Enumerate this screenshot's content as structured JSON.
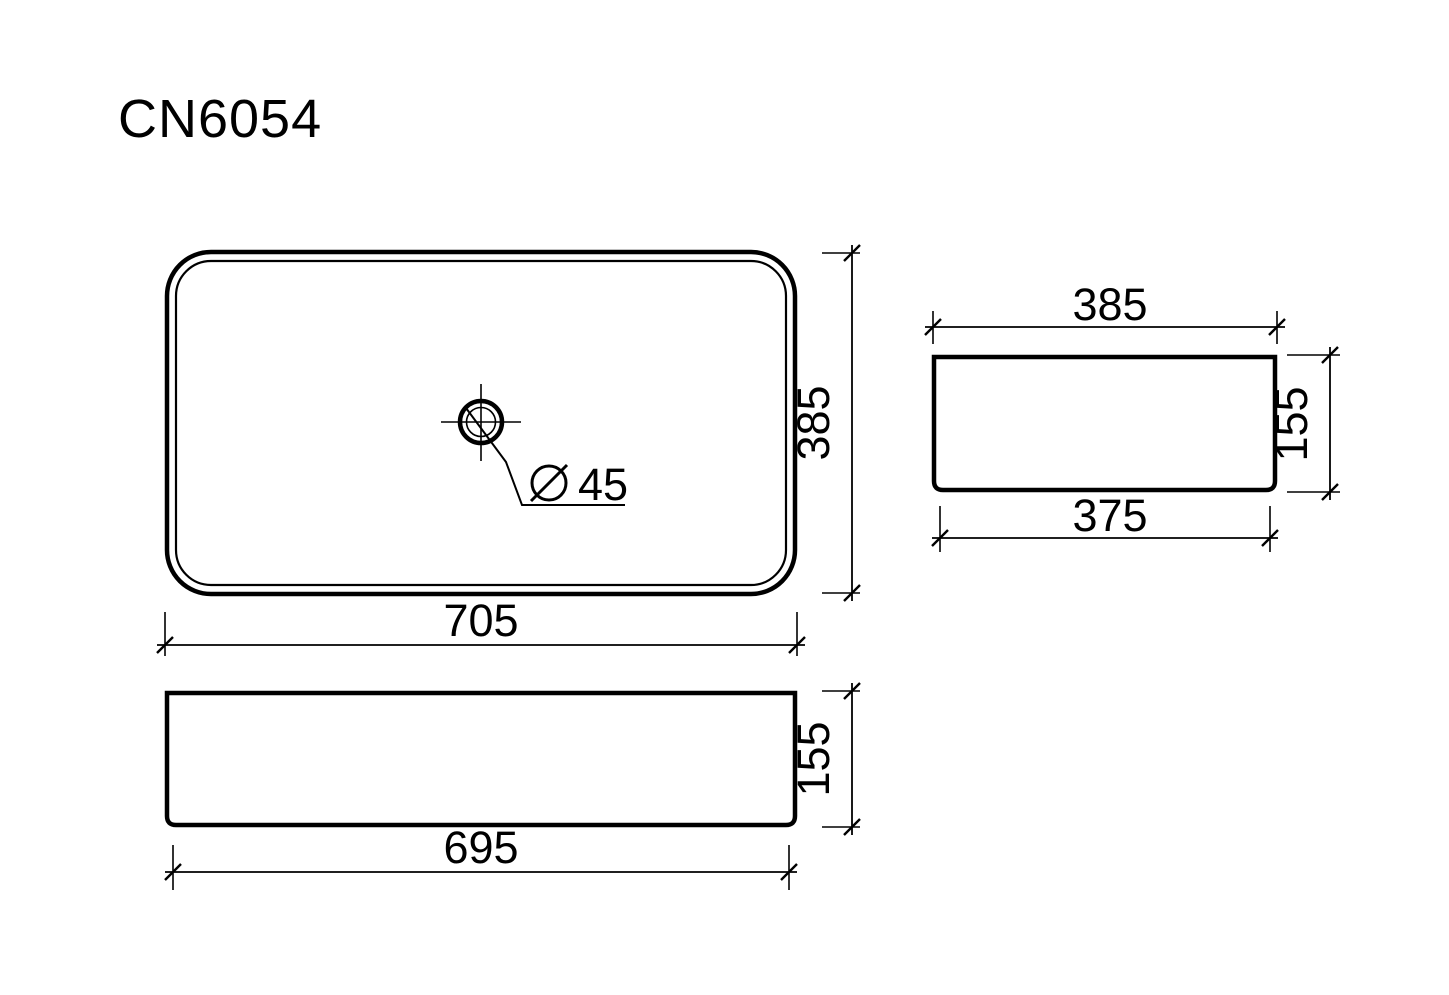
{
  "title": "CN6054",
  "views": {
    "top": {
      "label": "top-view-plan",
      "width": "705",
      "depth": "385",
      "drain_diameter": "45"
    },
    "side": {
      "label": "side-view",
      "top_width": "385",
      "bottom_width": "375",
      "height": "155"
    },
    "front": {
      "label": "front-view",
      "bottom_width": "695",
      "height": "155"
    }
  },
  "icons": {
    "diameter": "circle-with-slash"
  },
  "colors": {
    "line": "#000000",
    "background": "#ffffff"
  }
}
